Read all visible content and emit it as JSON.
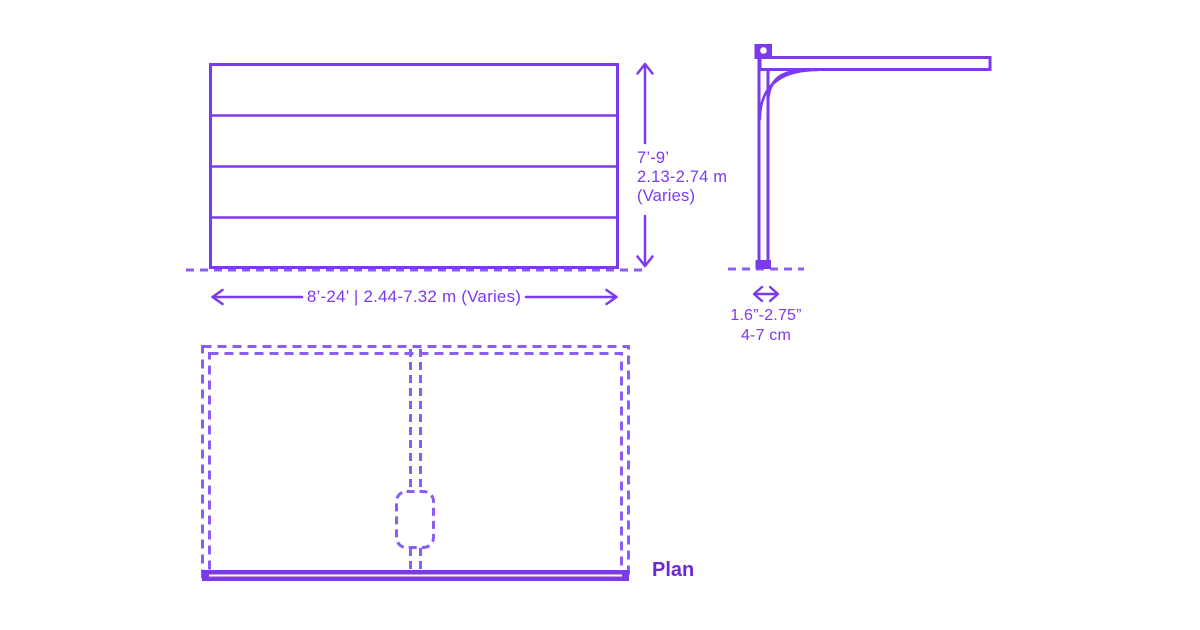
{
  "colors": {
    "solid_stroke": "#7C3AED",
    "dashed_stroke": "#8B5CF6",
    "dimension_text": "#7C3AED",
    "plan_label_text": "#6D28D9",
    "background": "#FFFFFF"
  },
  "front_elevation": {
    "panels": 4,
    "height_label_lines": [
      "7’-9’",
      "2.13-2.74 m",
      "(Varies)"
    ],
    "width_label": "8’-24’ | 2.44-7.32 m (Varies)"
  },
  "side_elevation": {
    "thickness_label_lines": [
      "1.6”-2.75”",
      "4-7 cm"
    ]
  },
  "plan": {
    "label": "Plan"
  }
}
